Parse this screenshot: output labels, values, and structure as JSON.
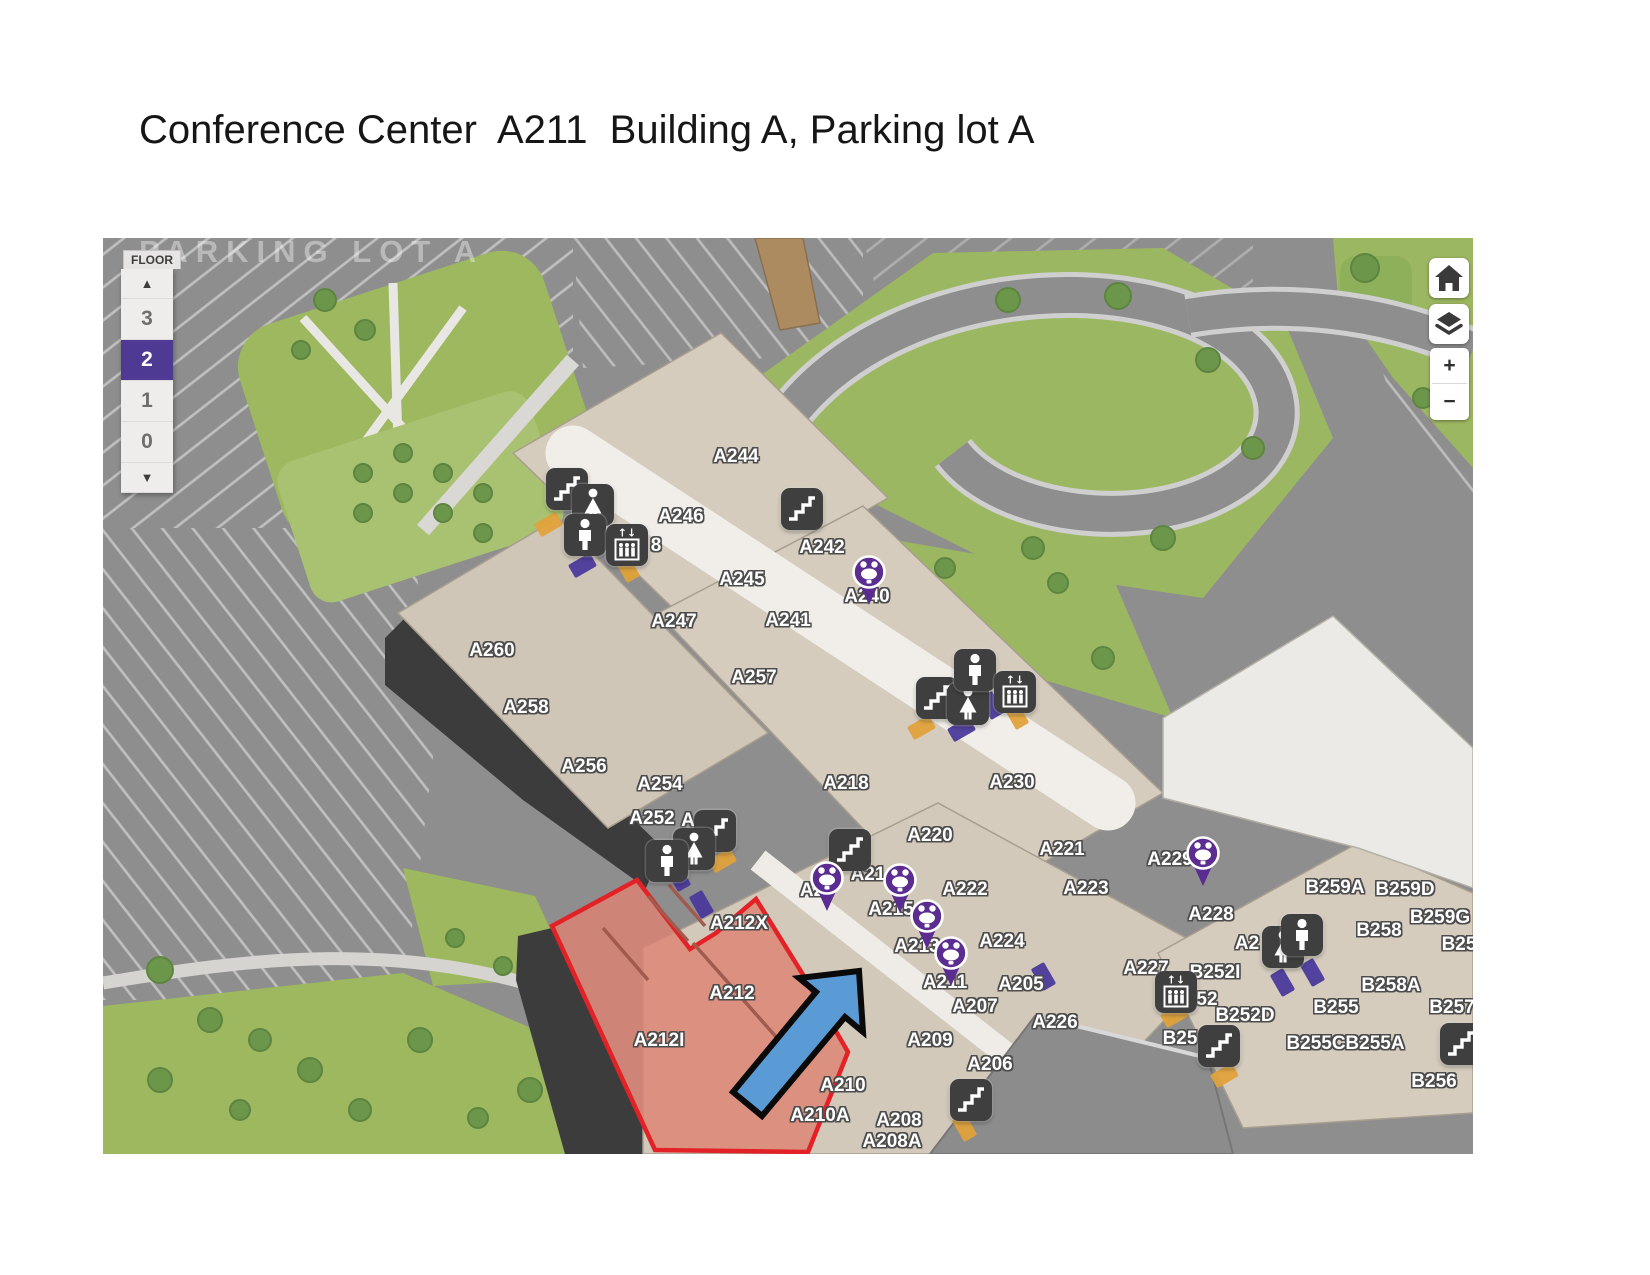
{
  "title": "Conference Center  A211  Building A, Parking lot A",
  "map": {
    "parking_label": "PARKING LOT A",
    "floor_selector": {
      "label": "FLOOR",
      "up_arrow": "▲",
      "down_arrow": "▼",
      "floors": [
        "3",
        "2",
        "1",
        "0"
      ],
      "selected": "2"
    },
    "controls": {
      "home": "home",
      "layers": "layers",
      "zoom_in": "+",
      "zoom_out": "−"
    },
    "colors": {
      "selected_floor": "#4e3a92",
      "pin": "#5c2d91",
      "highlight_fill": "rgba(222,130,112,0.80)",
      "highlight_border": "#e32227",
      "arrow_fill": "#5b9bd5",
      "arrow_outline": "#0a0a0a",
      "icon_bg": "#3f3f3f"
    },
    "rooms": [
      {
        "label": "A244",
        "x": 633,
        "y": 219
      },
      {
        "label": "A246",
        "x": 578,
        "y": 279
      },
      {
        "label": "8",
        "x": 553,
        "y": 308
      },
      {
        "label": "A242",
        "x": 719,
        "y": 310
      },
      {
        "label": "A245",
        "x": 639,
        "y": 342
      },
      {
        "label": "A240",
        "x": 764,
        "y": 359
      },
      {
        "label": "A247",
        "x": 571,
        "y": 384
      },
      {
        "label": "A241",
        "x": 685,
        "y": 383
      },
      {
        "label": "A260",
        "x": 389,
        "y": 413
      },
      {
        "label": "A257",
        "x": 651,
        "y": 440
      },
      {
        "label": "A258",
        "x": 423,
        "y": 470
      },
      {
        "label": "A256",
        "x": 481,
        "y": 529
      },
      {
        "label": "A254",
        "x": 557,
        "y": 547
      },
      {
        "label": "A252",
        "x": 549,
        "y": 581
      },
      {
        "label": "A",
        "x": 585,
        "y": 583
      },
      {
        "label": "A218",
        "x": 743,
        "y": 546
      },
      {
        "label": "A230",
        "x": 909,
        "y": 545
      },
      {
        "label": "A220",
        "x": 827,
        "y": 598
      },
      {
        "label": "A221",
        "x": 959,
        "y": 612
      },
      {
        "label": "A2",
        "x": 709,
        "y": 653
      },
      {
        "label": "A21",
        "x": 765,
        "y": 637
      },
      {
        "label": "A222",
        "x": 862,
        "y": 652
      },
      {
        "label": "A223",
        "x": 983,
        "y": 651
      },
      {
        "label": "A215",
        "x": 788,
        "y": 672
      },
      {
        "label": "A229",
        "x": 1067,
        "y": 622
      },
      {
        "label": "A228",
        "x": 1108,
        "y": 677
      },
      {
        "label": "B259A",
        "x": 1232,
        "y": 650
      },
      {
        "label": "B259D",
        "x": 1302,
        "y": 652
      },
      {
        "label": "B259G",
        "x": 1337,
        "y": 680
      },
      {
        "label": "B258",
        "x": 1276,
        "y": 693
      },
      {
        "label": "B25",
        "x": 1356,
        "y": 707
      },
      {
        "label": "A224",
        "x": 899,
        "y": 704
      },
      {
        "label": "A213",
        "x": 814,
        "y": 709
      },
      {
        "label": "A2",
        "x": 1144,
        "y": 706
      },
      {
        "label": "A211",
        "x": 842,
        "y": 745
      },
      {
        "label": "A205",
        "x": 918,
        "y": 747
      },
      {
        "label": "A227",
        "x": 1043,
        "y": 731
      },
      {
        "label": "B252I",
        "x": 1112,
        "y": 735
      },
      {
        "label": "52",
        "x": 1104,
        "y": 762
      },
      {
        "label": "A207",
        "x": 872,
        "y": 769
      },
      {
        "label": "B252D",
        "x": 1142,
        "y": 778
      },
      {
        "label": "A226",
        "x": 952,
        "y": 785
      },
      {
        "label": "B255",
        "x": 1233,
        "y": 770
      },
      {
        "label": "B258A",
        "x": 1288,
        "y": 748
      },
      {
        "label": "B257",
        "x": 1349,
        "y": 770
      },
      {
        "label": "A209",
        "x": 827,
        "y": 803
      },
      {
        "label": "B25",
        "x": 1077,
        "y": 801
      },
      {
        "label": "B255C",
        "x": 1213,
        "y": 806
      },
      {
        "label": "B255A",
        "x": 1272,
        "y": 806
      },
      {
        "label": "A206",
        "x": 887,
        "y": 827
      },
      {
        "label": "A212X",
        "x": 636,
        "y": 686
      },
      {
        "label": "A212",
        "x": 629,
        "y": 756
      },
      {
        "label": "A212I",
        "x": 556,
        "y": 803
      },
      {
        "label": "A210",
        "x": 740,
        "y": 848
      },
      {
        "label": "A210A",
        "x": 717,
        "y": 878
      },
      {
        "label": "A208",
        "x": 796,
        "y": 883
      },
      {
        "label": "A208A",
        "x": 789,
        "y": 904
      },
      {
        "label": "B256",
        "x": 1331,
        "y": 844
      }
    ],
    "icons": [
      {
        "type": "stairs",
        "x": 464,
        "y": 251
      },
      {
        "type": "woman",
        "x": 490,
        "y": 267
      },
      {
        "type": "man",
        "x": 482,
        "y": 297
      },
      {
        "type": "elevator",
        "x": 524,
        "y": 307
      },
      {
        "type": "stairs",
        "x": 699,
        "y": 271
      },
      {
        "type": "stairs",
        "x": 834,
        "y": 460
      },
      {
        "type": "woman",
        "x": 865,
        "y": 466
      },
      {
        "type": "man",
        "x": 872,
        "y": 432
      },
      {
        "type": "elevator",
        "x": 912,
        "y": 454
      },
      {
        "type": "stairs",
        "x": 612,
        "y": 593
      },
      {
        "type": "woman",
        "x": 591,
        "y": 611
      },
      {
        "type": "man",
        "x": 564,
        "y": 623
      },
      {
        "type": "stairs",
        "x": 747,
        "y": 612
      },
      {
        "type": "woman",
        "x": 1180,
        "y": 709
      },
      {
        "type": "man",
        "x": 1199,
        "y": 697
      },
      {
        "type": "elevator",
        "x": 1073,
        "y": 754
      },
      {
        "type": "stairs",
        "x": 868,
        "y": 862
      },
      {
        "type": "stairs",
        "x": 1116,
        "y": 808
      },
      {
        "type": "stairs",
        "x": 1358,
        "y": 806
      }
    ],
    "pins": [
      {
        "x": 766,
        "y": 334
      },
      {
        "x": 724,
        "y": 640
      },
      {
        "x": 797,
        "y": 642
      },
      {
        "x": 824,
        "y": 678
      },
      {
        "x": 848,
        "y": 715
      },
      {
        "x": 1100,
        "y": 615
      }
    ],
    "doors": [
      {
        "color": "#4b3a9b",
        "x": 479,
        "y": 328,
        "rot": -30
      },
      {
        "color": "#4b3a9b",
        "x": 575,
        "y": 640,
        "rot": 60
      },
      {
        "color": "#4b3a9b",
        "x": 598,
        "y": 667,
        "rot": 60
      },
      {
        "color": "#4b3a9b",
        "x": 888,
        "y": 468,
        "rot": 60
      },
      {
        "color": "#4b3a9b",
        "x": 858,
        "y": 492,
        "rot": -30
      },
      {
        "color": "#4b3a9b",
        "x": 940,
        "y": 739,
        "rot": 60
      },
      {
        "color": "#4b3a9b",
        "x": 1179,
        "y": 745,
        "rot": 60
      },
      {
        "color": "#4b3a9b",
        "x": 1209,
        "y": 735,
        "rot": 60
      },
      {
        "color": "#e0a23b",
        "x": 445,
        "y": 287,
        "rot": -30
      },
      {
        "color": "#e0a23b",
        "x": 524,
        "y": 331,
        "rot": 60
      },
      {
        "color": "#e0a23b",
        "x": 619,
        "y": 623,
        "rot": -30
      },
      {
        "color": "#e0a23b",
        "x": 818,
        "y": 490,
        "rot": -30
      },
      {
        "color": "#e0a23b",
        "x": 913,
        "y": 478,
        "rot": 60
      },
      {
        "color": "#e0a23b",
        "x": 1071,
        "y": 778,
        "rot": -30
      },
      {
        "color": "#e0a23b",
        "x": 861,
        "y": 890,
        "rot": 60
      },
      {
        "color": "#e0a23b",
        "x": 1121,
        "y": 838,
        "rot": -30
      }
    ],
    "highlight": {
      "room": "A212",
      "points": [
        [
          534,
          642
        ],
        [
          587,
          711
        ],
        [
          613,
          695
        ],
        [
          653,
          661
        ],
        [
          699,
          735
        ],
        [
          745,
          814
        ],
        [
          705,
          914
        ],
        [
          552,
          912
        ],
        [
          449,
          688
        ]
      ],
      "walls": [
        [
          545,
          658,
          585,
          703
        ],
        [
          566,
          647,
          602,
          688
        ],
        [
          500,
          690,
          545,
          742
        ],
        [
          590,
          705,
          690,
          818
        ]
      ]
    },
    "arrow": {
      "points": [
        [
          630,
          854
        ],
        [
          713,
          754
        ],
        [
          696,
          740
        ],
        [
          756,
          733
        ],
        [
          760,
          794
        ],
        [
          742,
          779
        ],
        [
          659,
          878
        ]
      ]
    }
  }
}
